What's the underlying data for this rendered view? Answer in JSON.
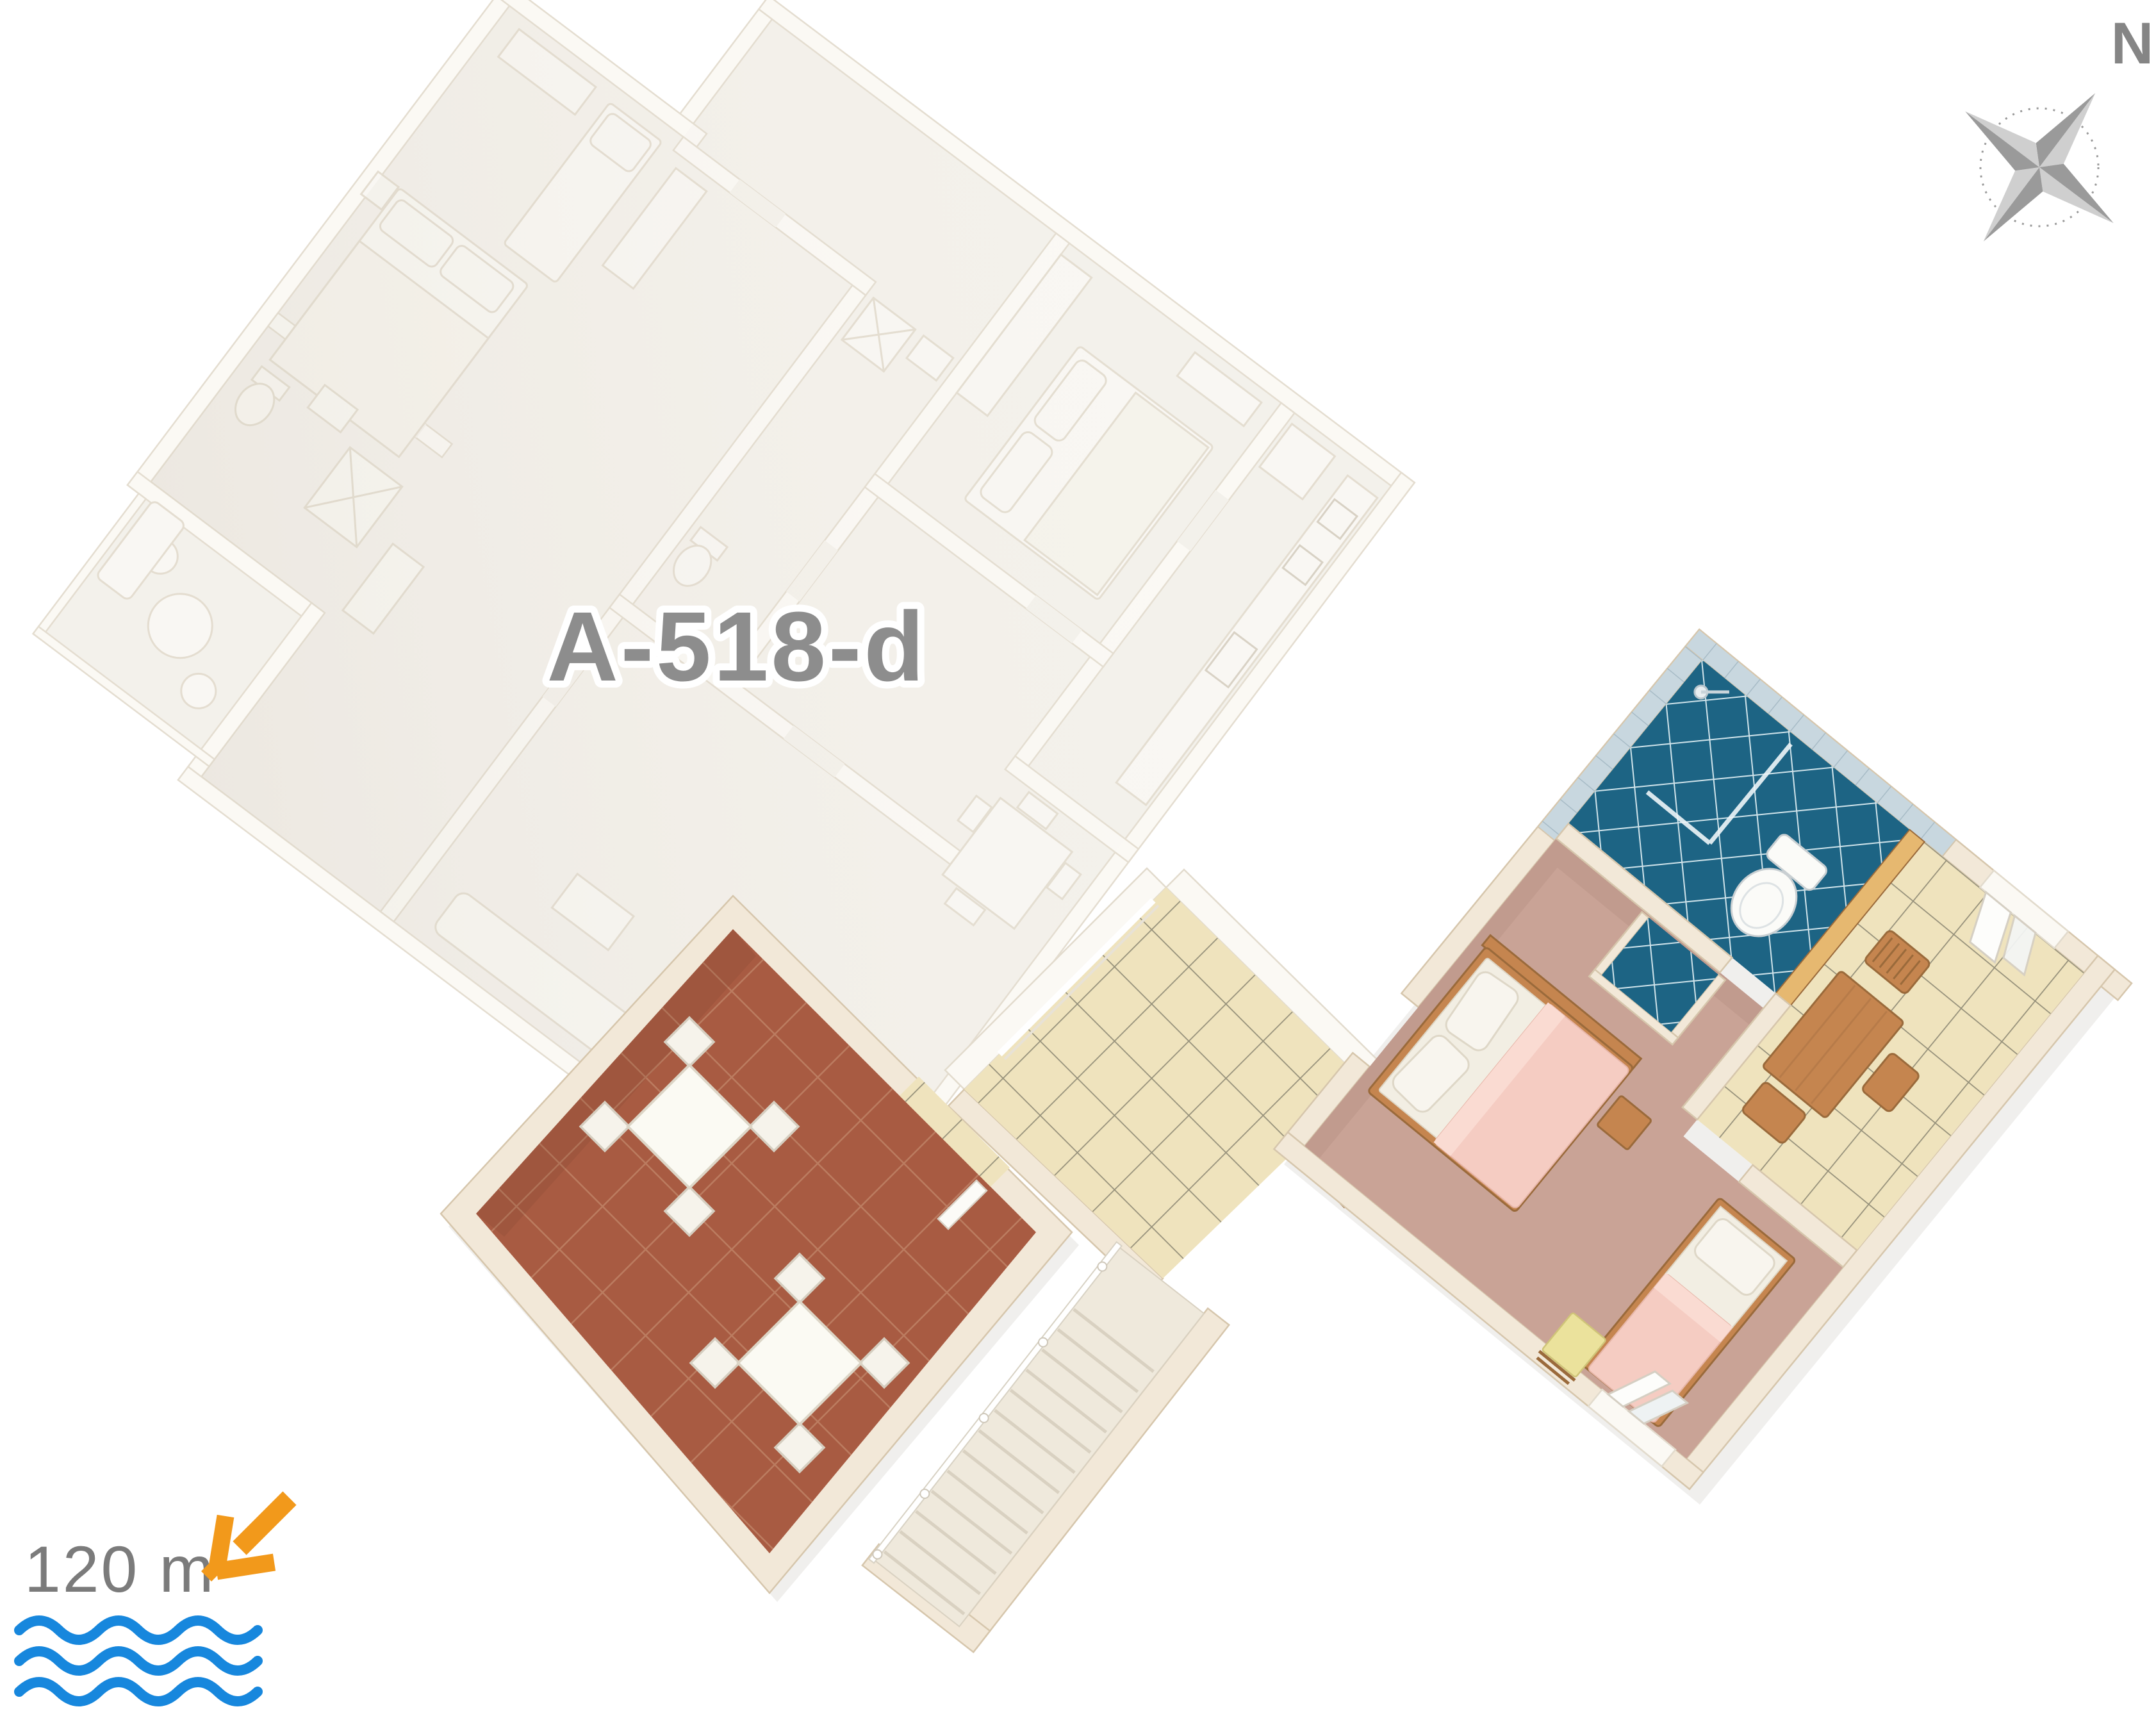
{
  "page": {
    "background": "#ffffff"
  },
  "plan": {
    "apartment_code": "A-518-d",
    "sea_distance": "120 m",
    "compass_north_label": "N"
  },
  "icons": {
    "compass": "compass-rose-icon",
    "sea_arrow": "arrow-down-left-icon",
    "sea_waves": "water-waves-icon"
  },
  "colors": {
    "page_bg": "#ffffff",
    "label_text": "#8d8d8d",
    "distance_text": "#7b7b7b",
    "compass_text": "#858585",
    "compass_dark": "#9a9a9a",
    "compass_light": "#cfcfcf",
    "arrow_orange": "#F2991B",
    "wave_blue": "#1787DD",
    "cream_wall": "#f2e8d8",
    "cream_wall_edge": "#d6c6ac",
    "white_floor": "#f3f0ea",
    "white_wall": "#fbf9f4",
    "white_line": "#e2dbcd",
    "white_furn": "#f9f7f2",
    "door_white": "#fcfbf7",
    "terracotta": "#a85b42",
    "terracotta_grout": "#c08468",
    "beige_tile": "#efe3bd",
    "beige_grout": "#95907a",
    "carpet": "#c9a396",
    "bath_floor": "#1d6484",
    "bath_grout": "#cfe3ea",
    "bath_wall": "#c8d7df",
    "bath_wall_grout": "#a7bbc6",
    "wood": "#c5854f",
    "wood_dark": "#9a6a3b",
    "wood_light": "#e6b870",
    "stair_floor": "#efe9dc",
    "stair_line": "#d9d1c1",
    "pink": "#f5ccc2",
    "pink_light": "#fadbd2",
    "mattress": "#f2eee3",
    "pillow": "#f8f5ee",
    "towel_yellow": "#ebe29c",
    "towel_edge": "#cfc478",
    "table_white": "#fbfaf3",
    "chair_white": "#f6f3eb",
    "set_stroke": "#d5cec0"
  },
  "scene": {
    "highlighted_unit_rooms": [
      "dining-room",
      "terrace",
      "bedroom",
      "bathroom",
      "kitchen",
      "staircase"
    ],
    "faded_unit_rooms": [
      "bedroom-1",
      "bedroom-2",
      "bathroom-1",
      "bathroom-2",
      "kitchen",
      "living-room",
      "balcony"
    ]
  }
}
